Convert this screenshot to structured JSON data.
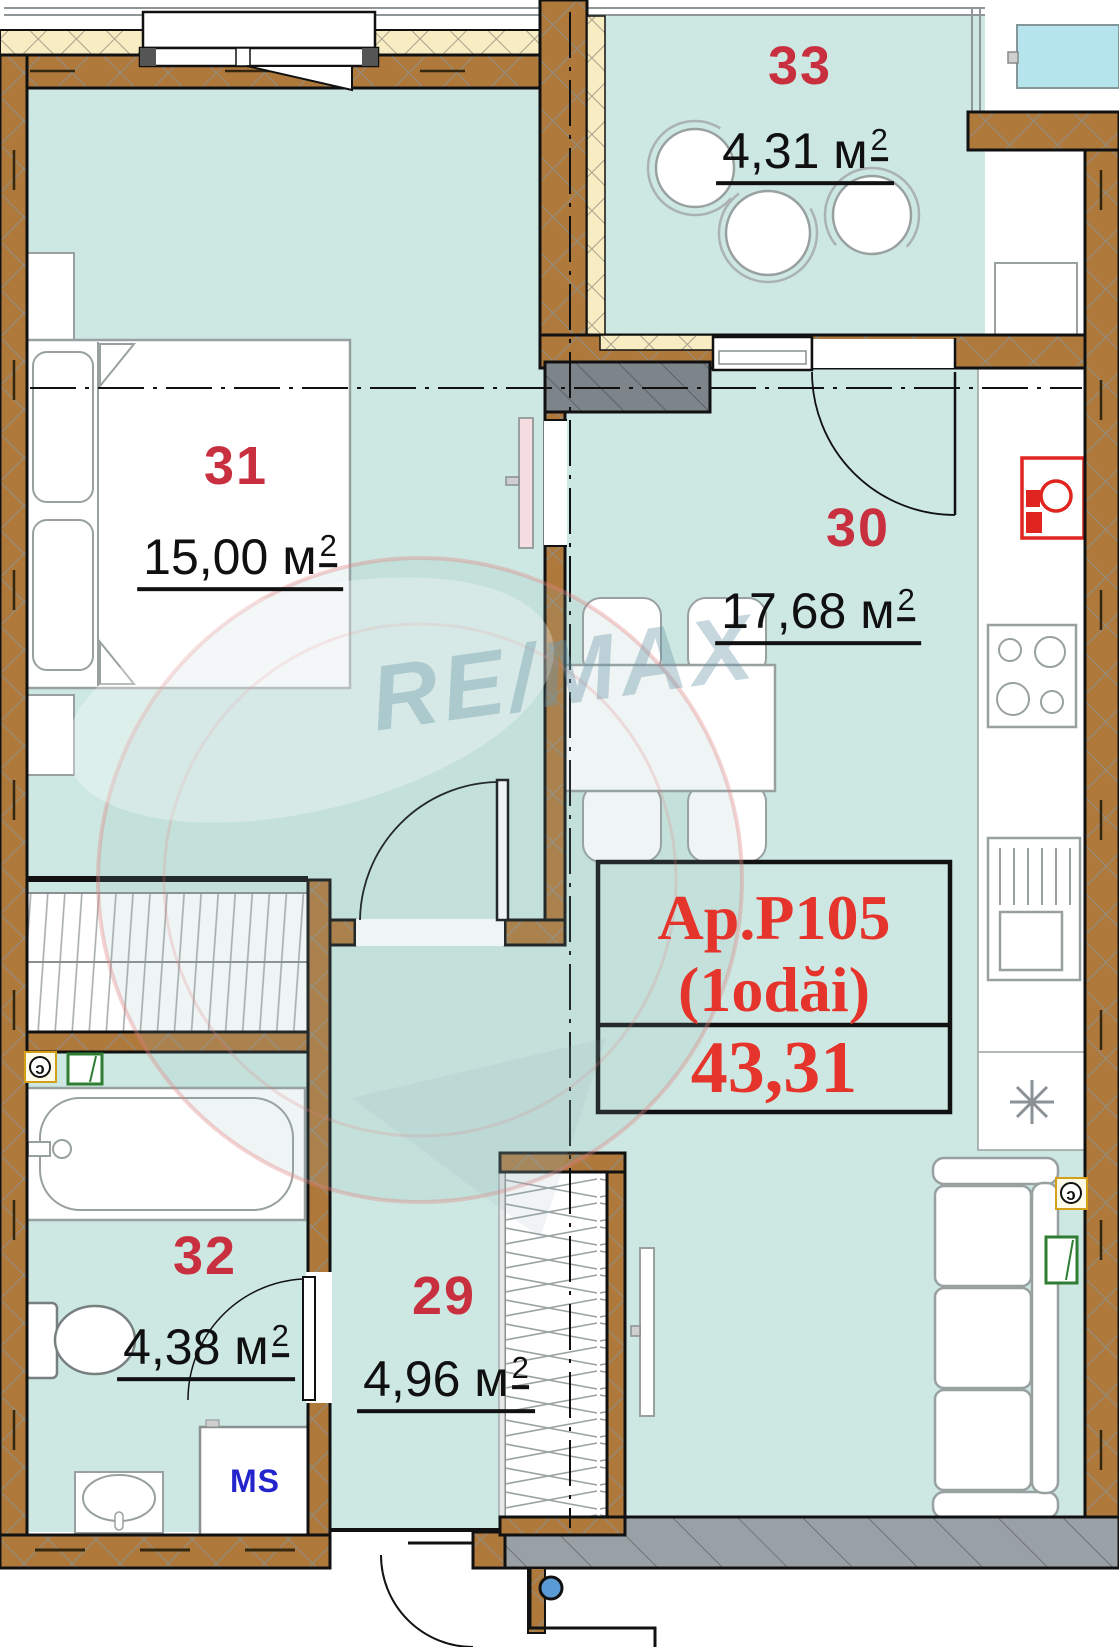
{
  "title": "Apartment floor plan",
  "watermark": {
    "brand": "RE/MAX"
  },
  "unit_label": {
    "name": "Ap.P105",
    "rooms": "(1odăi)",
    "total_area": "43,31"
  },
  "rooms": [
    {
      "number": "31",
      "area_value": "15,00",
      "area_unit": "м",
      "area_exp": "2"
    },
    {
      "number": "30",
      "area_value": "17,68",
      "area_unit": "м",
      "area_exp": "2"
    },
    {
      "number": "33",
      "area_value": "4,31",
      "area_unit": "м",
      "area_exp": "2"
    },
    {
      "number": "32",
      "area_value": "4,38",
      "area_unit": "м",
      "area_exp": "2"
    },
    {
      "number": "29",
      "area_value": "4,96",
      "area_unit": "м",
      "area_exp": "2"
    }
  ],
  "appliances": {
    "washing_machine": "MS"
  },
  "colors": {
    "floor_teal": "#cde8e2",
    "wall_brown": "#b0793c",
    "insulation_cream": "#f7ecc2",
    "room_number_red": "#c9303f",
    "unit_label_red": "#e5342c",
    "ms_blue": "#2424cc",
    "exterior_glass_cyan": "#b5e4ec",
    "slab_gray": "#9aa1a6"
  }
}
